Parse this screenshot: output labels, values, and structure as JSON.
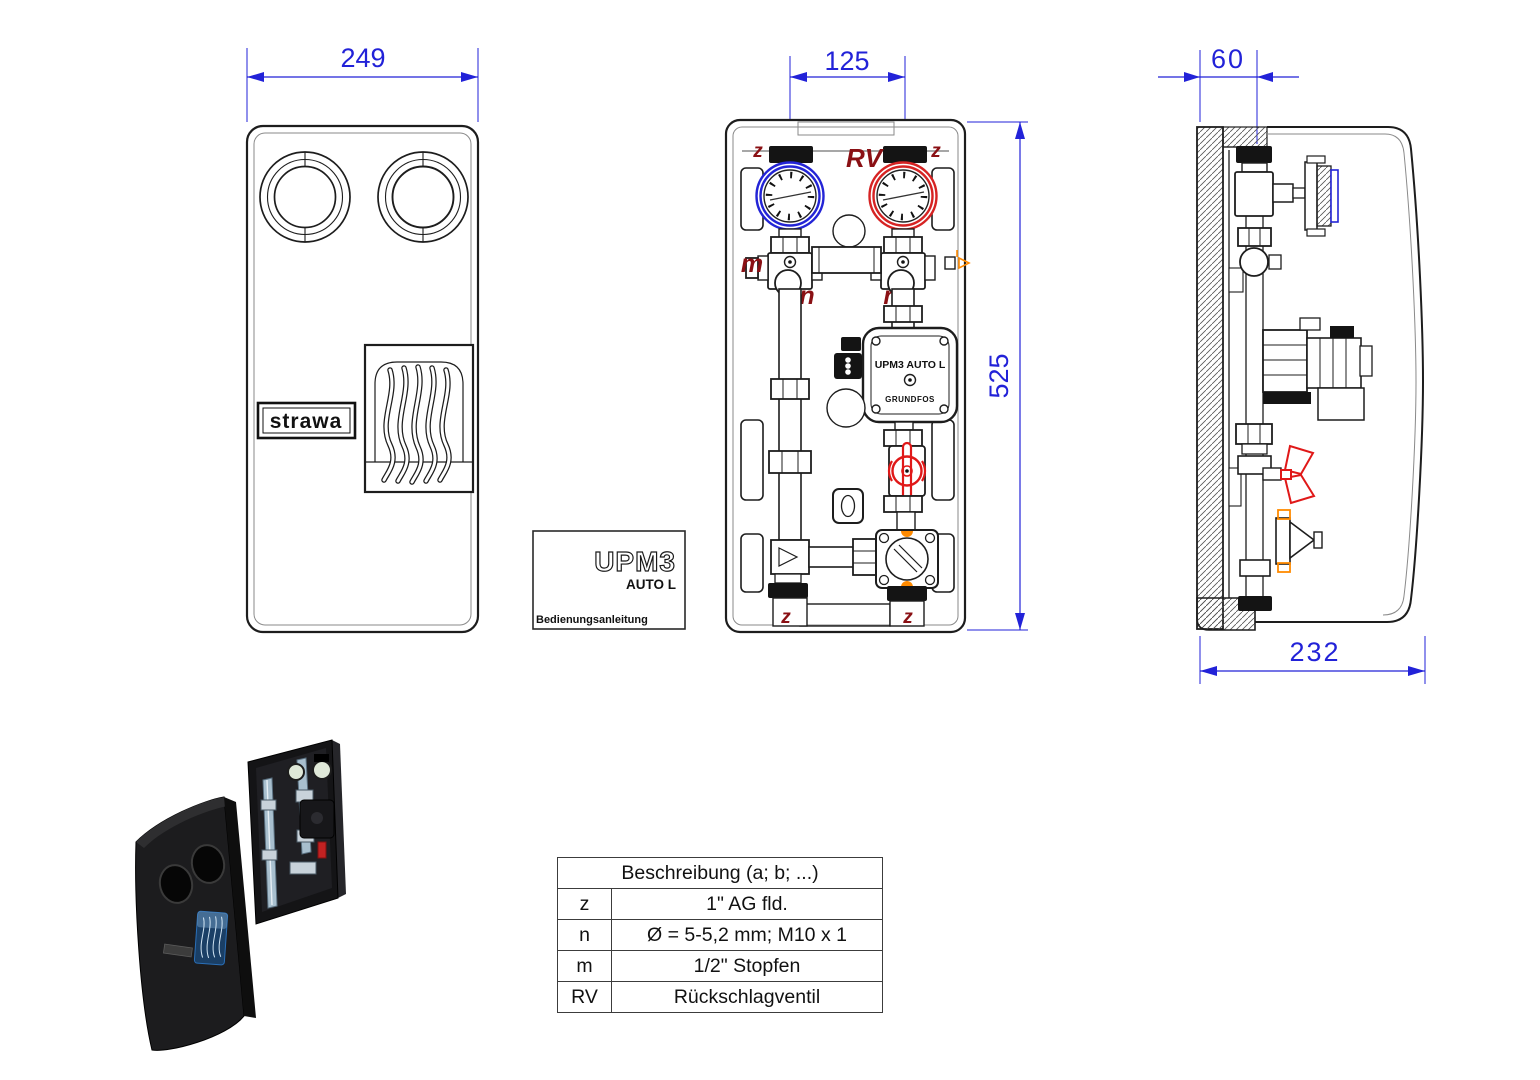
{
  "dimensions": {
    "front_width": "249",
    "port_pitch": "125",
    "height": "525",
    "depth_offset": "60",
    "depth": "232"
  },
  "labels": {
    "z": "z",
    "rv": "RV",
    "m": "m",
    "n": "n"
  },
  "branding": {
    "logo": "strawa"
  },
  "pump": {
    "model": "UPM3 AUTO L",
    "brand": "GRUNDFOS"
  },
  "manual": {
    "model": "UPM3",
    "variant": "AUTO L",
    "caption": "Bedienungsanleitung"
  },
  "legend": {
    "header": "Beschreibung (a; b; ...)",
    "rows": [
      {
        "key": "z",
        "value": "1\" AG fld."
      },
      {
        "key": "n",
        "value": "Ø = 5-5,2 mm; M10 x 1"
      },
      {
        "key": "m",
        "value": "1/2\" Stopfen"
      },
      {
        "key": "RV",
        "value": "Rückschlagventil"
      }
    ]
  },
  "colors": {
    "dimension_blue": "#2222d8",
    "label_dark_red": "#8a1014",
    "valve_red": "#e01818",
    "accent_orange": "#ff8a00",
    "line": "#1d1d1d"
  }
}
